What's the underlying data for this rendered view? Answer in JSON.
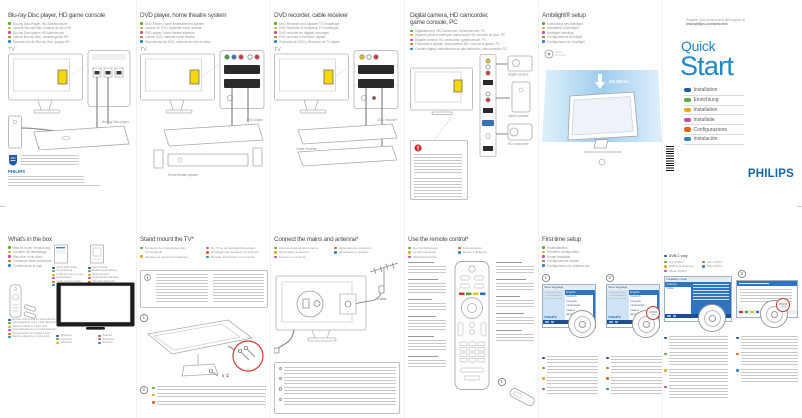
{
  "flags": {
    "en": "#2458a8",
    "de": "#63a83a",
    "fr": "#e8a91f",
    "nl": "#b9529f",
    "it": "#e2641e",
    "es": "#2e86c1"
  },
  "colors": {
    "philips_blue": "#1466ac",
    "quickstart_blue": "#2187ca",
    "screen_blue": "#2f74c0",
    "screen_dark_blue": "#1d4e8f",
    "ambilight_glow": "#b5daf3",
    "highlight_yellow": "#f6d70a",
    "alert_red": "#d0342c"
  },
  "top_panels": [
    {
      "title": "Blu-ray Disc player, HD game console",
      "translations": [
        {
          "lang": "de",
          "text": "Blu-ray Disc-Player, HD-Spielekonsole"
        },
        {
          "lang": "fr",
          "text": "Lecteur Blu-ray Disc, console de jeux HD"
        },
        {
          "lang": "nl",
          "text": "Blu-ray Disc-speler, HD-spelconsole"
        },
        {
          "lang": "it",
          "text": "Lettore Blu-ray Disc, console giochi HD"
        },
        {
          "lang": "es",
          "text": "Reproductor de Blu-ray Disc, juegos HD"
        }
      ],
      "tv_label": "TV",
      "devices": [
        "Blu-ray Disc player",
        "HD game console"
      ]
    },
    {
      "title": "DVD player, home theatre system",
      "translations": [
        {
          "lang": "de",
          "text": "DVD-Player, Home Entertainment-System"
        },
        {
          "lang": "fr",
          "text": "Lecteur de DVD, système home cinéma"
        },
        {
          "lang": "nl",
          "text": "DVD-speler, home theatre systeem"
        },
        {
          "lang": "it",
          "text": "Lettore DVD, sistema home theatre"
        },
        {
          "lang": "es",
          "text": "Reproductor de DVD, sistema de cine en casa"
        }
      ],
      "tv_label": "TV",
      "devices": [
        "DVD player",
        "Home theatre system"
      ]
    },
    {
      "title": "DVD recorder, cable receiver",
      "translations": [
        {
          "lang": "de",
          "text": "DVD-Recorder und digitaler TV-Empfänger"
        },
        {
          "lang": "fr",
          "text": "DVD Recorder et récepteur TV numérique"
        },
        {
          "lang": "nl",
          "text": "DVD-recorder en digitale ontvanger"
        },
        {
          "lang": "it",
          "text": "DVD recorder e ricevitore digitale"
        },
        {
          "lang": "es",
          "text": "Grabador de DVD y Receptor de TV digital"
        }
      ],
      "tv_label": "TV",
      "devices": [
        "DVD recorder",
        "Cable receiver"
      ]
    },
    {
      "title_line1": "Digital camera, HD camcorder,",
      "title_line2": "game console, PC",
      "translations": [
        {
          "lang": "de",
          "text": "Digitalkamera, HD-Camcorder, Spielekonsole, PC"
        },
        {
          "lang": "fr",
          "text": "Appareil photo numérique, caméscope HD, console de jeux, PC"
        },
        {
          "lang": "nl",
          "text": "Digitale camera, HD-camcorder, gameconsole, PC"
        },
        {
          "lang": "it",
          "text": "Fotocamera digitale, videocamera HD, console di giochi, PC"
        },
        {
          "lang": "es",
          "text": "Cámara digital, videocámara de alta definición, videoconsola, PC"
        }
      ],
      "devices": [
        "Digital camera",
        "Game console",
        "HD camcorder"
      ]
    },
    {
      "title": "Ambilight® setup",
      "translations": [
        {
          "lang": "de",
          "text": "Einrichtung des Ambilight"
        },
        {
          "lang": "fr",
          "text": "Installation d'Ambilight"
        },
        {
          "lang": "nl",
          "text": "Ambilight instelling"
        },
        {
          "lang": "it",
          "text": "Configurazione Ambilight"
        },
        {
          "lang": "es",
          "text": "Configuración de Ambilight"
        }
      ],
      "distance_label": "10-20cm"
    }
  ],
  "cover": {
    "register_line1": "Register your product and get support at",
    "register_line2": "www.philips.com/welcome",
    "title_line1": "Quick",
    "title_line2": "Start",
    "languages": [
      {
        "lang": "en",
        "label": "Installation"
      },
      {
        "lang": "de",
        "label": "Einrichtung"
      },
      {
        "lang": "fr",
        "label": "Installation"
      },
      {
        "lang": "nl",
        "label": "Installatie"
      },
      {
        "lang": "it",
        "label": "Configurazione"
      },
      {
        "lang": "es",
        "label": "Instalación"
      }
    ],
    "brand": "PHILIPS"
  },
  "bottom_panels": {
    "box": {
      "title": "What's in the box",
      "translations": [
        {
          "lang": "de",
          "text": "Was ist in der Verpackung"
        },
        {
          "lang": "fr",
          "text": "Contenu de l'emballage"
        },
        {
          "lang": "nl",
          "text": "Wat zit er in de doos"
        },
        {
          "lang": "it",
          "text": "Contenuto della confezione"
        },
        {
          "lang": "es",
          "text": "Contenido de la caja"
        }
      ],
      "quick_start_guide": [
        {
          "lang": "en",
          "text": "Quick Start Guide"
        },
        {
          "lang": "de",
          "text": "Kurzanleitung"
        },
        {
          "lang": "fr",
          "text": "Guide de mise en route"
        },
        {
          "lang": "nl",
          "text": "Snelstartgids"
        },
        {
          "lang": "it",
          "text": "Guida di avvio rapido"
        },
        {
          "lang": "es",
          "text": "Guía de inicio rápido"
        }
      ],
      "user_manual": [
        {
          "lang": "en",
          "text": "User Manual"
        },
        {
          "lang": "de",
          "text": "Bedienungsanleitung"
        },
        {
          "lang": "fr",
          "text": "Mode d'emploi"
        },
        {
          "lang": "nl",
          "text": "Gebruikershandleiding"
        },
        {
          "lang": "it",
          "text": "Manuale dell'utente"
        },
        {
          "lang": "es",
          "text": "Manual del usuario"
        }
      ],
      "remote": [
        {
          "lang": "en",
          "text": "Remote control and 2 x AAA batteries"
        },
        {
          "lang": "de",
          "text": "Fernbedienung und 2 x AAA-Batterien"
        },
        {
          "lang": "fr",
          "text": "Télécommande et 2 piles AAA"
        },
        {
          "lang": "nl",
          "text": "Afstandsbediening en 2 AAA-batterijen"
        },
        {
          "lang": "it",
          "text": "Telecomando con 2 batterie AAA"
        },
        {
          "lang": "es",
          "text": "Mando a distancia y 2 pilas AAA"
        }
      ],
      "television": [
        {
          "lang": "en",
          "text": "Television"
        },
        {
          "lang": "de",
          "text": "Fernseher"
        },
        {
          "lang": "fr",
          "text": "Téléviseur"
        },
        {
          "lang": "nl",
          "text": "Televisie"
        },
        {
          "lang": "it",
          "text": "Televisore"
        },
        {
          "lang": "es",
          "text": "Televisor"
        }
      ]
    },
    "stand": {
      "title": "Stand mount the TV*",
      "translations": [
        {
          "lang": "de",
          "text": "Montieren des Standfußes beim Fernsehgerät"
        },
        {
          "lang": "fr",
          "text": "Montage du support du téléviseur"
        },
        {
          "lang": "nl",
          "text": "De TV op de standaard bevestigen"
        },
        {
          "lang": "it",
          "text": "Montaggio del televisore sul supporto"
        },
        {
          "lang": "es",
          "text": "Montaje del televisor en el soporte"
        }
      ],
      "screws_label": "x 4",
      "steps": [
        "1",
        "2"
      ]
    },
    "mains": {
      "title": "Connect the mains and antenna*",
      "translations": [
        {
          "lang": "de",
          "text": "Stromversorgung und Antenne"
        },
        {
          "lang": "fr",
          "text": "Alimentation et antenne"
        },
        {
          "lang": "nl",
          "text": "Netsnoer en antenne"
        },
        {
          "lang": "it",
          "text": "Alimentazione e antenna"
        },
        {
          "lang": "es",
          "text": "Alimentación y antena"
        }
      ],
      "cable_label": "Cable"
    },
    "remote": {
      "title": "Use the remote control*",
      "translations": [
        {
          "lang": "de",
          "text": "Die Fernbedienung"
        },
        {
          "lang": "fr",
          "text": "La télécommande"
        },
        {
          "lang": "nl",
          "text": "Afstandsbediening"
        },
        {
          "lang": "it",
          "text": "Il telecomando"
        },
        {
          "lang": "es",
          "text": "Mando a distancia"
        }
      ],
      "detail_step": "1"
    },
    "setup": {
      "title": "First time setup",
      "translations": [
        {
          "lang": "de",
          "text": "Erstinstallation"
        },
        {
          "lang": "fr",
          "text": "Première configuration"
        },
        {
          "lang": "nl",
          "text": "Eerste installatie"
        },
        {
          "lang": "it",
          "text": "Configurazione iniziale"
        },
        {
          "lang": "es",
          "text": "Configuración por primera vez"
        }
      ],
      "steps": [
        "1",
        "2"
      ],
      "screen": {
        "header": "Menu language",
        "brand": "PHILIPS",
        "languages": [
          "English",
          "Deutsch",
          "Français",
          "Nederlands",
          "Italiano",
          "Español"
        ]
      }
    },
    "dvbc": {
      "header": "DVB-C only",
      "translations": [
        {
          "lang": "de",
          "text": "Nur DVB-C"
        },
        {
          "lang": "fr",
          "text": "DVB-C uniquement"
        },
        {
          "lang": "nl",
          "text": "Alleen DVB-C"
        },
        {
          "lang": "it",
          "text": "Solo DVB-C"
        },
        {
          "lang": "es",
          "text": "Sólo DVB-C"
        }
      ],
      "step": "3",
      "screen": {
        "header": "Installation mode",
        "options": [
          "Antenna",
          "Cable"
        ]
      }
    }
  }
}
